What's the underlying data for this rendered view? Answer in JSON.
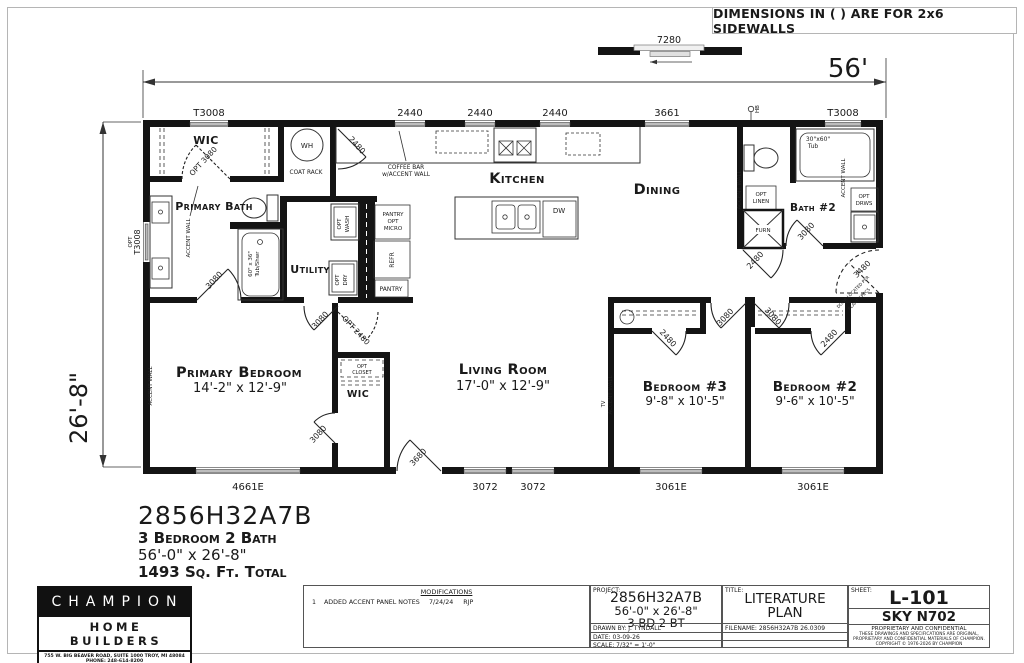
{
  "note": "DIMENSIONS IN ( ) ARE FOR 2x6 SIDEWALLS",
  "plan_title": {
    "model": "2856H32A7B",
    "config": "3 Bedroom 2 Bath",
    "size": "56'-0\" x 26'-8\"",
    "area": "1493 Sq. Ft. Total"
  },
  "dims": {
    "overall_width": "56'",
    "overall_depth": "26'-8\"",
    "opt_slider": "7280",
    "top_windows": [
      "T3008",
      "2440",
      "2440",
      "2440",
      "3661",
      "T3008"
    ],
    "bottom_windows": [
      "4661E",
      "3072",
      "3072",
      "3061E",
      "3061E"
    ],
    "left_window": [
      "OPT",
      "T3008"
    ]
  },
  "doors": {
    "wic_opt": "OPT 3080",
    "coat": "2480",
    "primary_bath": "3080",
    "utility": "3080",
    "wic2_opt": "OPT 2480",
    "primary_bedroom": "3080",
    "entry": "3680",
    "bedroom3": "3080",
    "bedroom2": "3080",
    "bedroom3_closet": "2480",
    "bedroom2_closet": "2480",
    "bath2": "3080",
    "furnace": "2480",
    "rear": "3480",
    "rear_note": [
      "DOOR LOCATED PER",
      "PLANT SPECS"
    ]
  },
  "rooms": {
    "wic": "WIC",
    "wic2": "WIC",
    "primary_bath": "Primary Bath",
    "utility": "Utility",
    "kitchen": "Kitchen",
    "dining": "Dining",
    "bath2": "Bath #2",
    "living": {
      "name": "Living Room",
      "size": "17'-0\" x 12'-9\""
    },
    "primary_bedroom": {
      "name": "Primary Bedroom",
      "size": "14'-2\" x 12'-9\""
    },
    "bedroom3": {
      "name": "Bedroom #3",
      "size": "9'-8\" x 10'-5\""
    },
    "bedroom2": {
      "name": "Bedroom #2",
      "size": "9'-6\" x 10'-5\""
    }
  },
  "fixtures": {
    "wh": "WH",
    "coat_rack": "COAT RACK",
    "coffee_bar": [
      "COFFEE BAR",
      "w/ACCENT WALL"
    ],
    "pantry_micro": [
      "PANTRY",
      "OPT",
      "MICRO"
    ],
    "refr": "REFR",
    "pantry": "PANTRY",
    "opt_wash": [
      "OPT",
      "WASH"
    ],
    "opt_dry": [
      "OPT",
      "DRY"
    ],
    "opt_closet": [
      "OPT",
      "CLOSET"
    ],
    "opt_linen": [
      "OPT",
      "LINEN"
    ],
    "opt_drws": [
      "OPT",
      "DRWS"
    ],
    "furn": "FURN",
    "dw": "DW",
    "hb": "HB",
    "tub_bath2": [
      "30\"x60\"",
      "Tub"
    ],
    "tub_primary": [
      "60\" x 36\"",
      "Tub/Shwr"
    ],
    "accent_wall": "ACCENT WALL",
    "tv": "TV"
  },
  "colors": {
    "wall": "#141414",
    "window": "#bdbdbd",
    "line": "#333333"
  },
  "titleblock": {
    "logo": {
      "name": "CHAMPION",
      "sub": "HOME BUILDERS",
      "addr": "755 W. BIG BEAVER ROAD, SUITE 1000 TROY, MI 48084",
      "phone": "PHONE: 248-614-8200"
    },
    "mods": {
      "heading": "MODIFICATIONS",
      "row_num": "1",
      "row_text": "ADDED ACCENT PANEL NOTES",
      "row_date": "7/24/24",
      "row_by": "RJP"
    },
    "project": {
      "label": "PROJECT:",
      "model": "2856H32A7B",
      "size": "56'-0\" x 26'-8\"",
      "config": "3 BD 2 BT",
      "drawn": "DRAWN BY: J. TYNDALL",
      "date": "DATE: 03-09-26",
      "scale": "SCALE: 7/32\" = 1'-0\""
    },
    "title": {
      "label": "TITLE:",
      "line1": "LITERATURE",
      "line2": "PLAN",
      "filename": "FILENAME: 2856H32A7B 26.0309"
    },
    "sheet": {
      "label": "SHEET:",
      "number": "L-101",
      "model": "SKY N702",
      "prop1": "PROPRIETARY AND CONFIDENTIAL",
      "prop2": "THESE DRAWINGS AND SPECIFICATIONS ARE ORIGINAL,",
      "prop3": "PROPRIETARY AND CONFIDENTIAL MATERIALS OF CHAMPION.",
      "prop4": "COPYRIGHT © 1976-2026 BY CHAMPION"
    }
  }
}
